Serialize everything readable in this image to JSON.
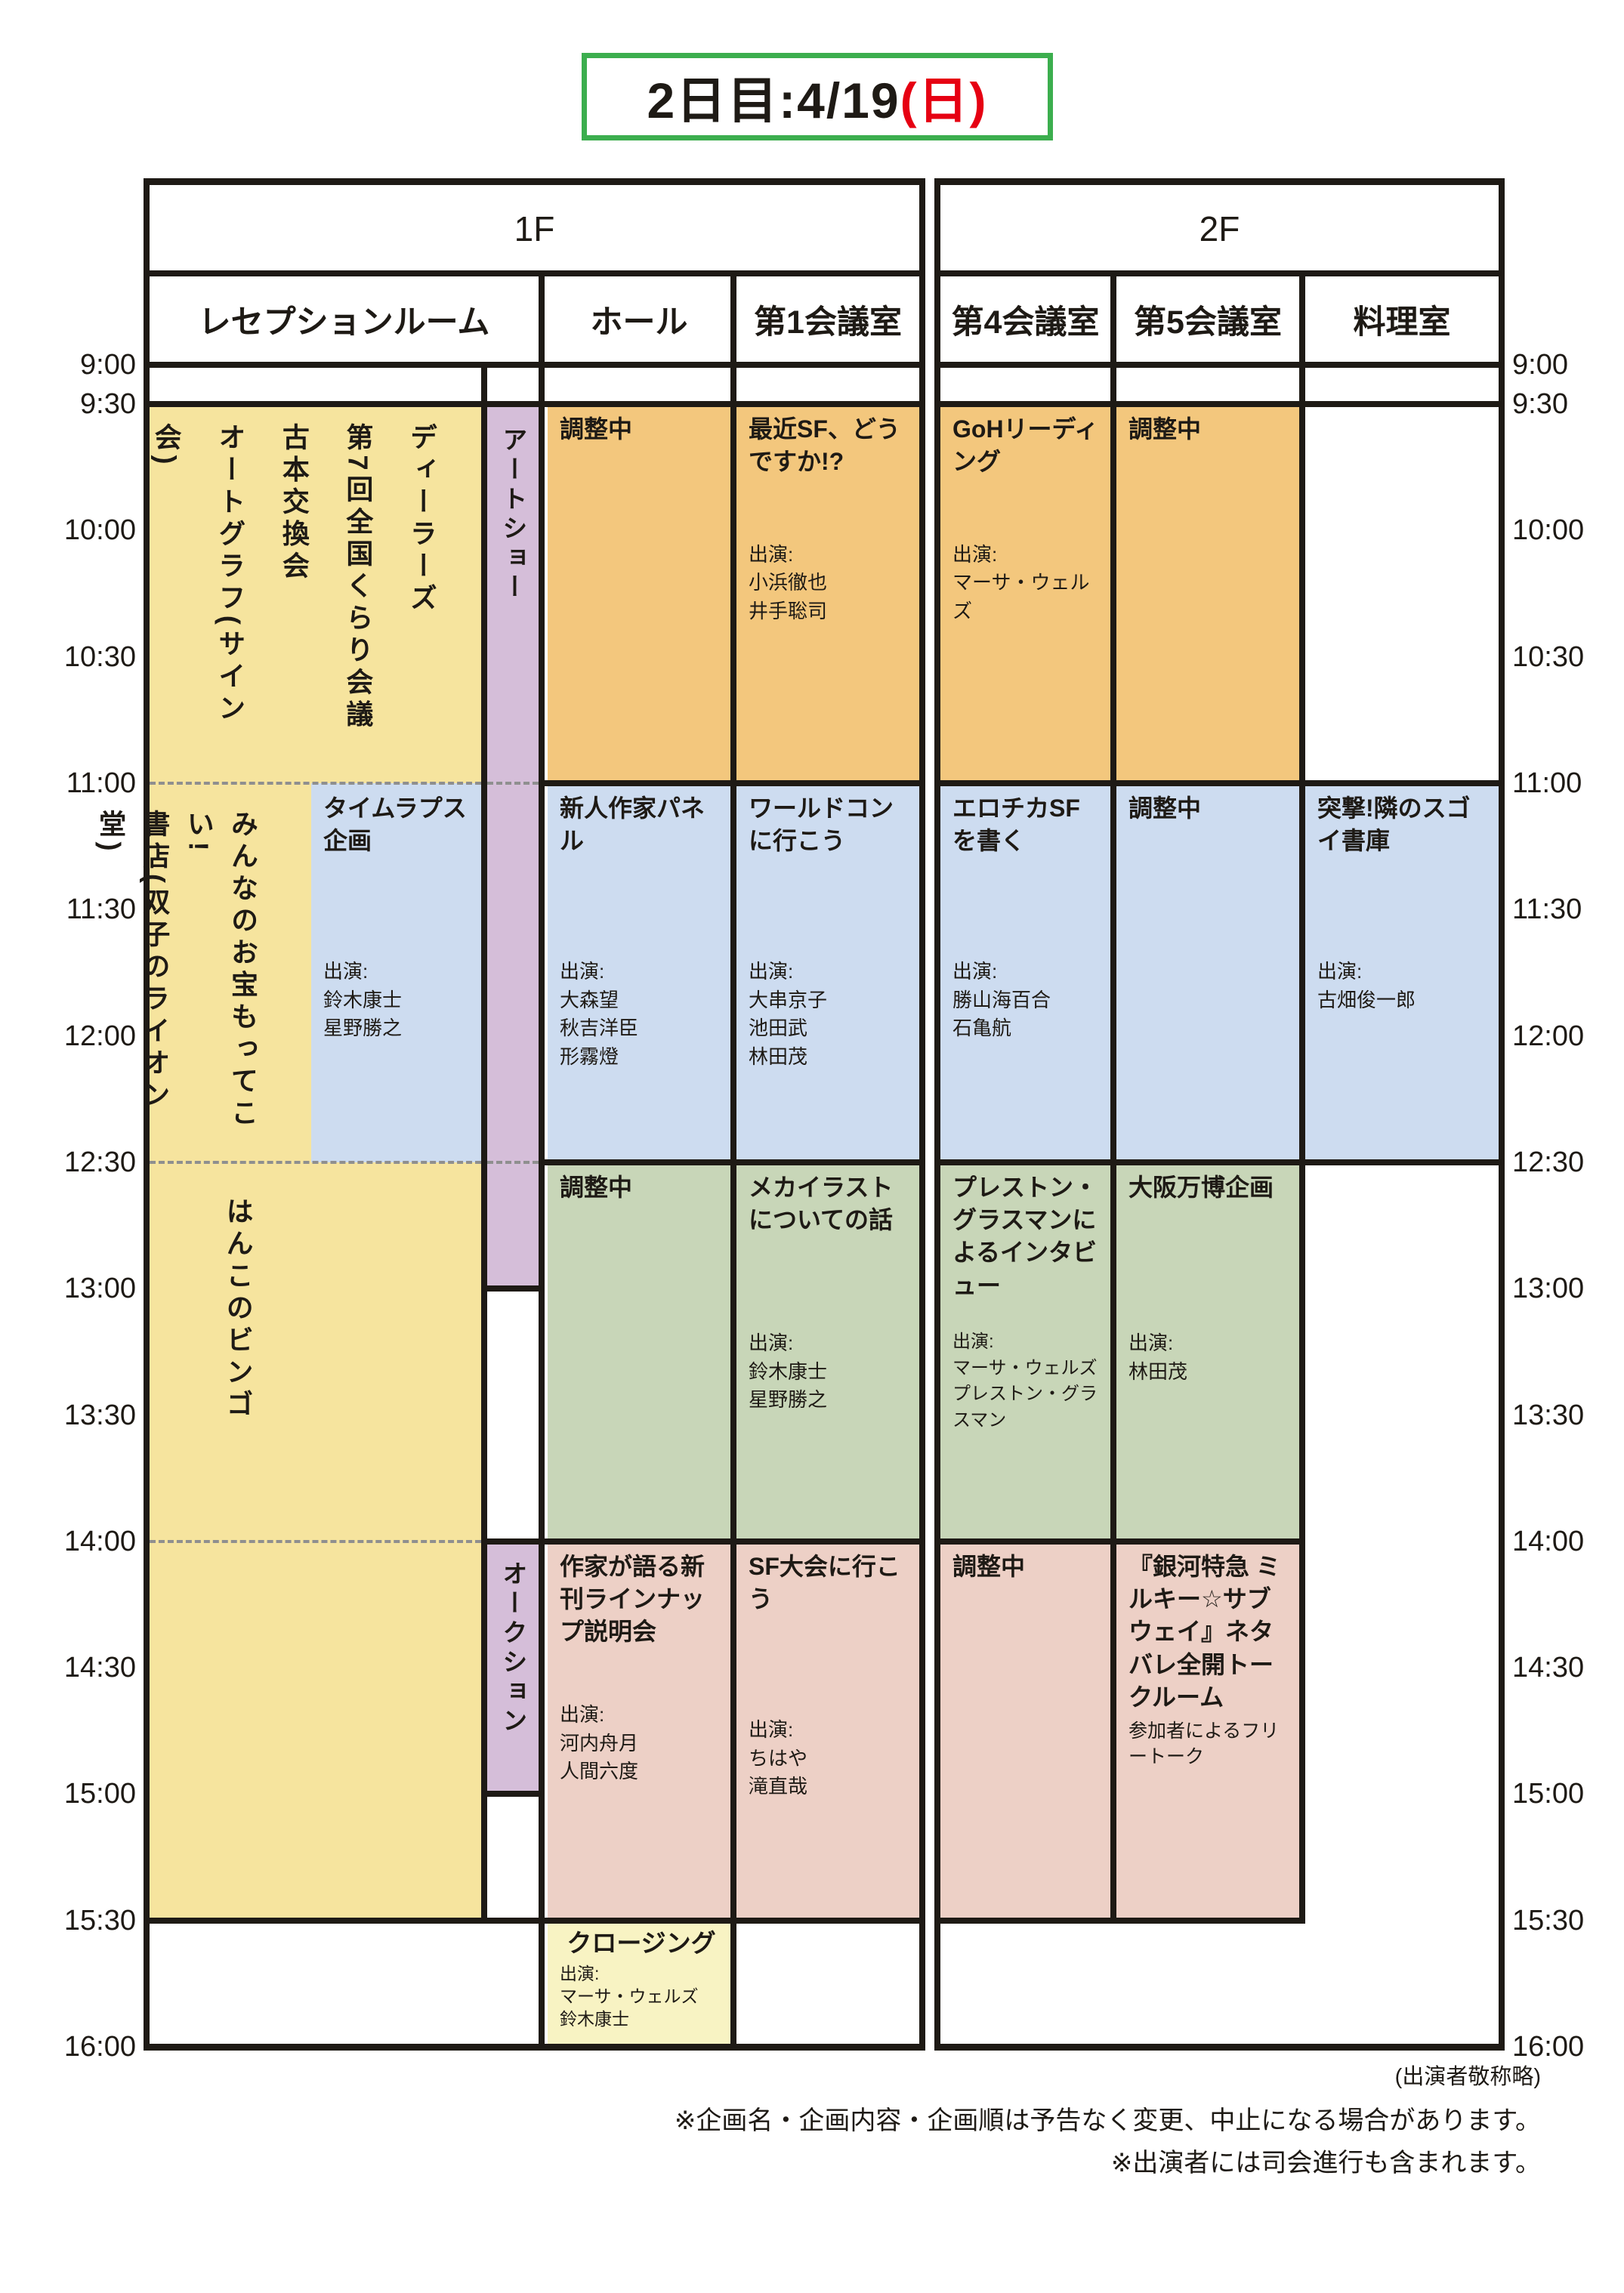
{
  "title": {
    "text": "2日目:4/19",
    "weekday": "(日)"
  },
  "palette": {
    "yellow": "#f6e49e",
    "pale_yellow": "#f8f3c3",
    "orange": "#f3c77d",
    "blue": "#cddcf0",
    "green": "#c8d6b8",
    "pink": "#edd0c6",
    "purple": "#d5bed9",
    "red": "#e60012",
    "green_frame": "#3cae4e",
    "line_black": "#1e1a15",
    "dash_gray": "#8f8f8f"
  },
  "labels": {
    "cast": "出演:"
  },
  "floors": {
    "f1": "1F",
    "f2": "2F"
  },
  "rooms": {
    "reception": "レセプションルーム",
    "hall": "ホール",
    "room1": "第1会議室",
    "room4": "第4会議室",
    "room5": "第5会議室",
    "cooking": "料理室"
  },
  "times": [
    "9:00",
    "9:30",
    "10:00",
    "10:30",
    "11:00",
    "11:30",
    "12:00",
    "12:30",
    "13:00",
    "13:30",
    "14:00",
    "14:30",
    "15:00",
    "15:30",
    "16:00"
  ],
  "events": {
    "dealers": {
      "lines": [
        "ディーラーズ",
        "第7回全国くらり会議",
        "古本交換会",
        "オートグラフ(サイン会)"
      ]
    },
    "treasure": {
      "lines": [
        "みんなのお宝もってこい!",
        "書店(双子のライオン堂)"
      ]
    },
    "bingo": {
      "title": "はんこのビンゴ"
    },
    "artshow": {
      "title": "アートショー"
    },
    "auction": {
      "title": "オークション"
    },
    "timelapse": {
      "title": "タイムラプス企画",
      "cast": [
        "鈴木康士",
        "星野勝之"
      ]
    },
    "hall_0930": {
      "title": "調整中"
    },
    "hall_1100": {
      "title": "新人作家パネル",
      "cast": [
        "大森望",
        "秋吉洋臣",
        "形霧燈"
      ]
    },
    "hall_1230": {
      "title": "調整中"
    },
    "hall_1400": {
      "title": "作家が語る新刊ラインナップ説明会",
      "cast": [
        "河内舟月",
        "人間六度"
      ]
    },
    "hall_1530": {
      "title": "クロージング",
      "cast": [
        "マーサ・ウェルズ",
        "鈴木康士"
      ]
    },
    "r1_0930": {
      "title": "最近SF、どうですか!?",
      "cast": [
        "小浜徹也",
        "井手聡司"
      ]
    },
    "r1_1100": {
      "title": "ワールドコンに行こう",
      "cast": [
        "大串京子",
        "池田武",
        "林田茂"
      ]
    },
    "r1_1230": {
      "title": "メカイラストについての話",
      "cast": [
        "鈴木康士",
        "星野勝之"
      ]
    },
    "r1_1400": {
      "title": "SF大会に行こう",
      "cast": [
        "ちはや",
        "滝直哉"
      ]
    },
    "r4_0930": {
      "title": "GoHリーディング",
      "cast": [
        "マーサ・ウェルズ"
      ]
    },
    "r4_1100": {
      "title": "エロチカSFを書く",
      "cast": [
        "勝山海百合",
        "石亀航"
      ]
    },
    "r4_1230": {
      "title": "プレストン・グラスマンによるインタビュー",
      "cast": [
        "マーサ・ウェルズ",
        "プレストン・グラスマン"
      ]
    },
    "r4_1400": {
      "title": "調整中"
    },
    "r5_0930": {
      "title": "調整中"
    },
    "r5_1100": {
      "title": "調整中"
    },
    "r5_1230": {
      "title": "大阪万博企画",
      "cast": [
        "林田茂"
      ]
    },
    "r5_1400": {
      "title": "『銀河特急 ミルキー☆サブウェイ』ネタバレ全開トークルーム",
      "subtitle": "参加者によるフリートーク"
    },
    "cook_1100": {
      "title": "突撃!隣のスゴイ書庫",
      "cast": [
        "古畑俊一郎"
      ]
    }
  },
  "footer": {
    "honorific": "(出演者敬称略)",
    "note1": "※企画名・企画内容・企画順は予告なく変更、中止になる場合があります。",
    "note2": "※出演者には司会進行も含まれます。"
  }
}
